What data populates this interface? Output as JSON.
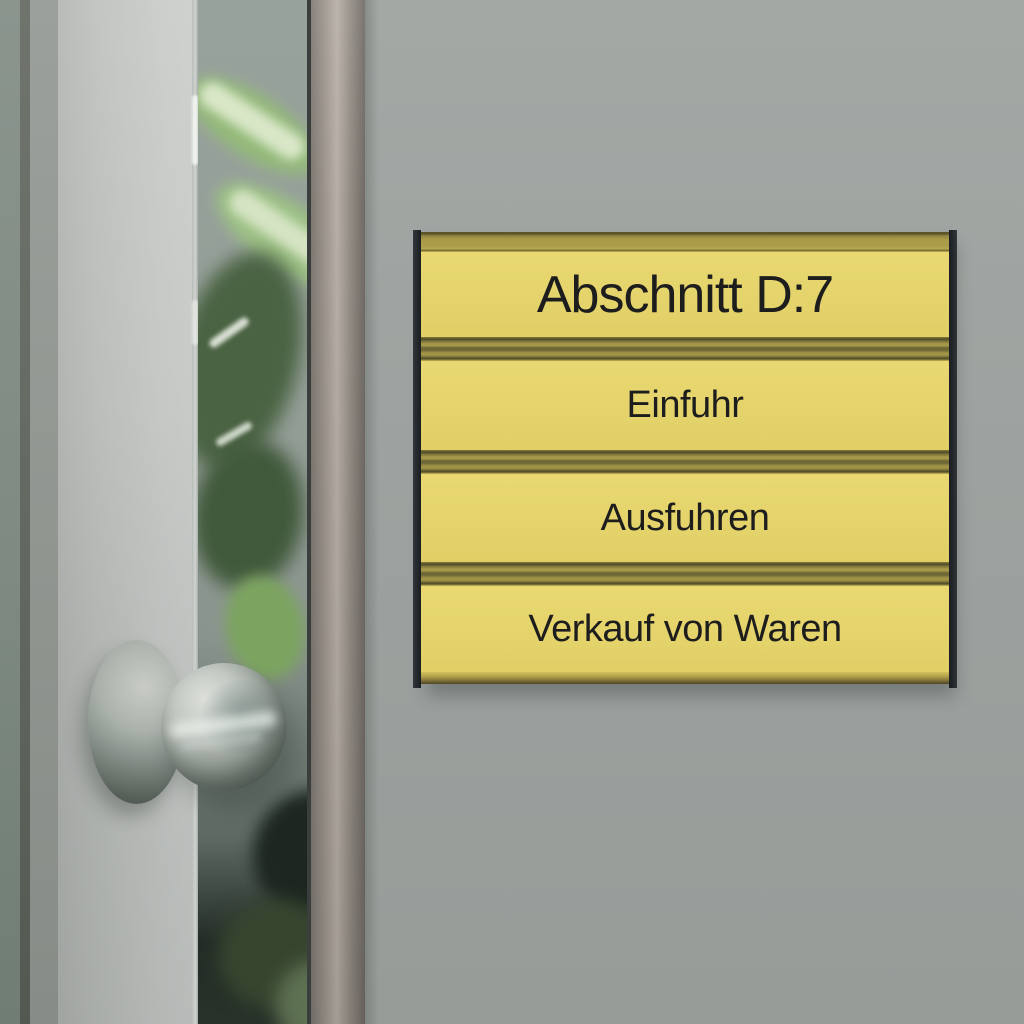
{
  "sign": {
    "title": "Abschnitt D:7",
    "rows": [
      "Einfuhr",
      "Ausfuhren",
      "Verkauf von Waren"
    ]
  },
  "colors": {
    "sign_panel_yellow": "#e8d669",
    "sign_gold_strip": "#a89a48",
    "sign_groove_dark": "#6e6634",
    "sign_side_rail": "#1e2226",
    "sign_text": "#1d1d1d",
    "wall_gray": "#9ca29f",
    "door_gray": "#bfc2bf",
    "glass_gray_green": "#939e97",
    "plant_green": "#94ba7a",
    "metal_frame": "#a49c94",
    "knob_metal": "#9aa29b"
  }
}
